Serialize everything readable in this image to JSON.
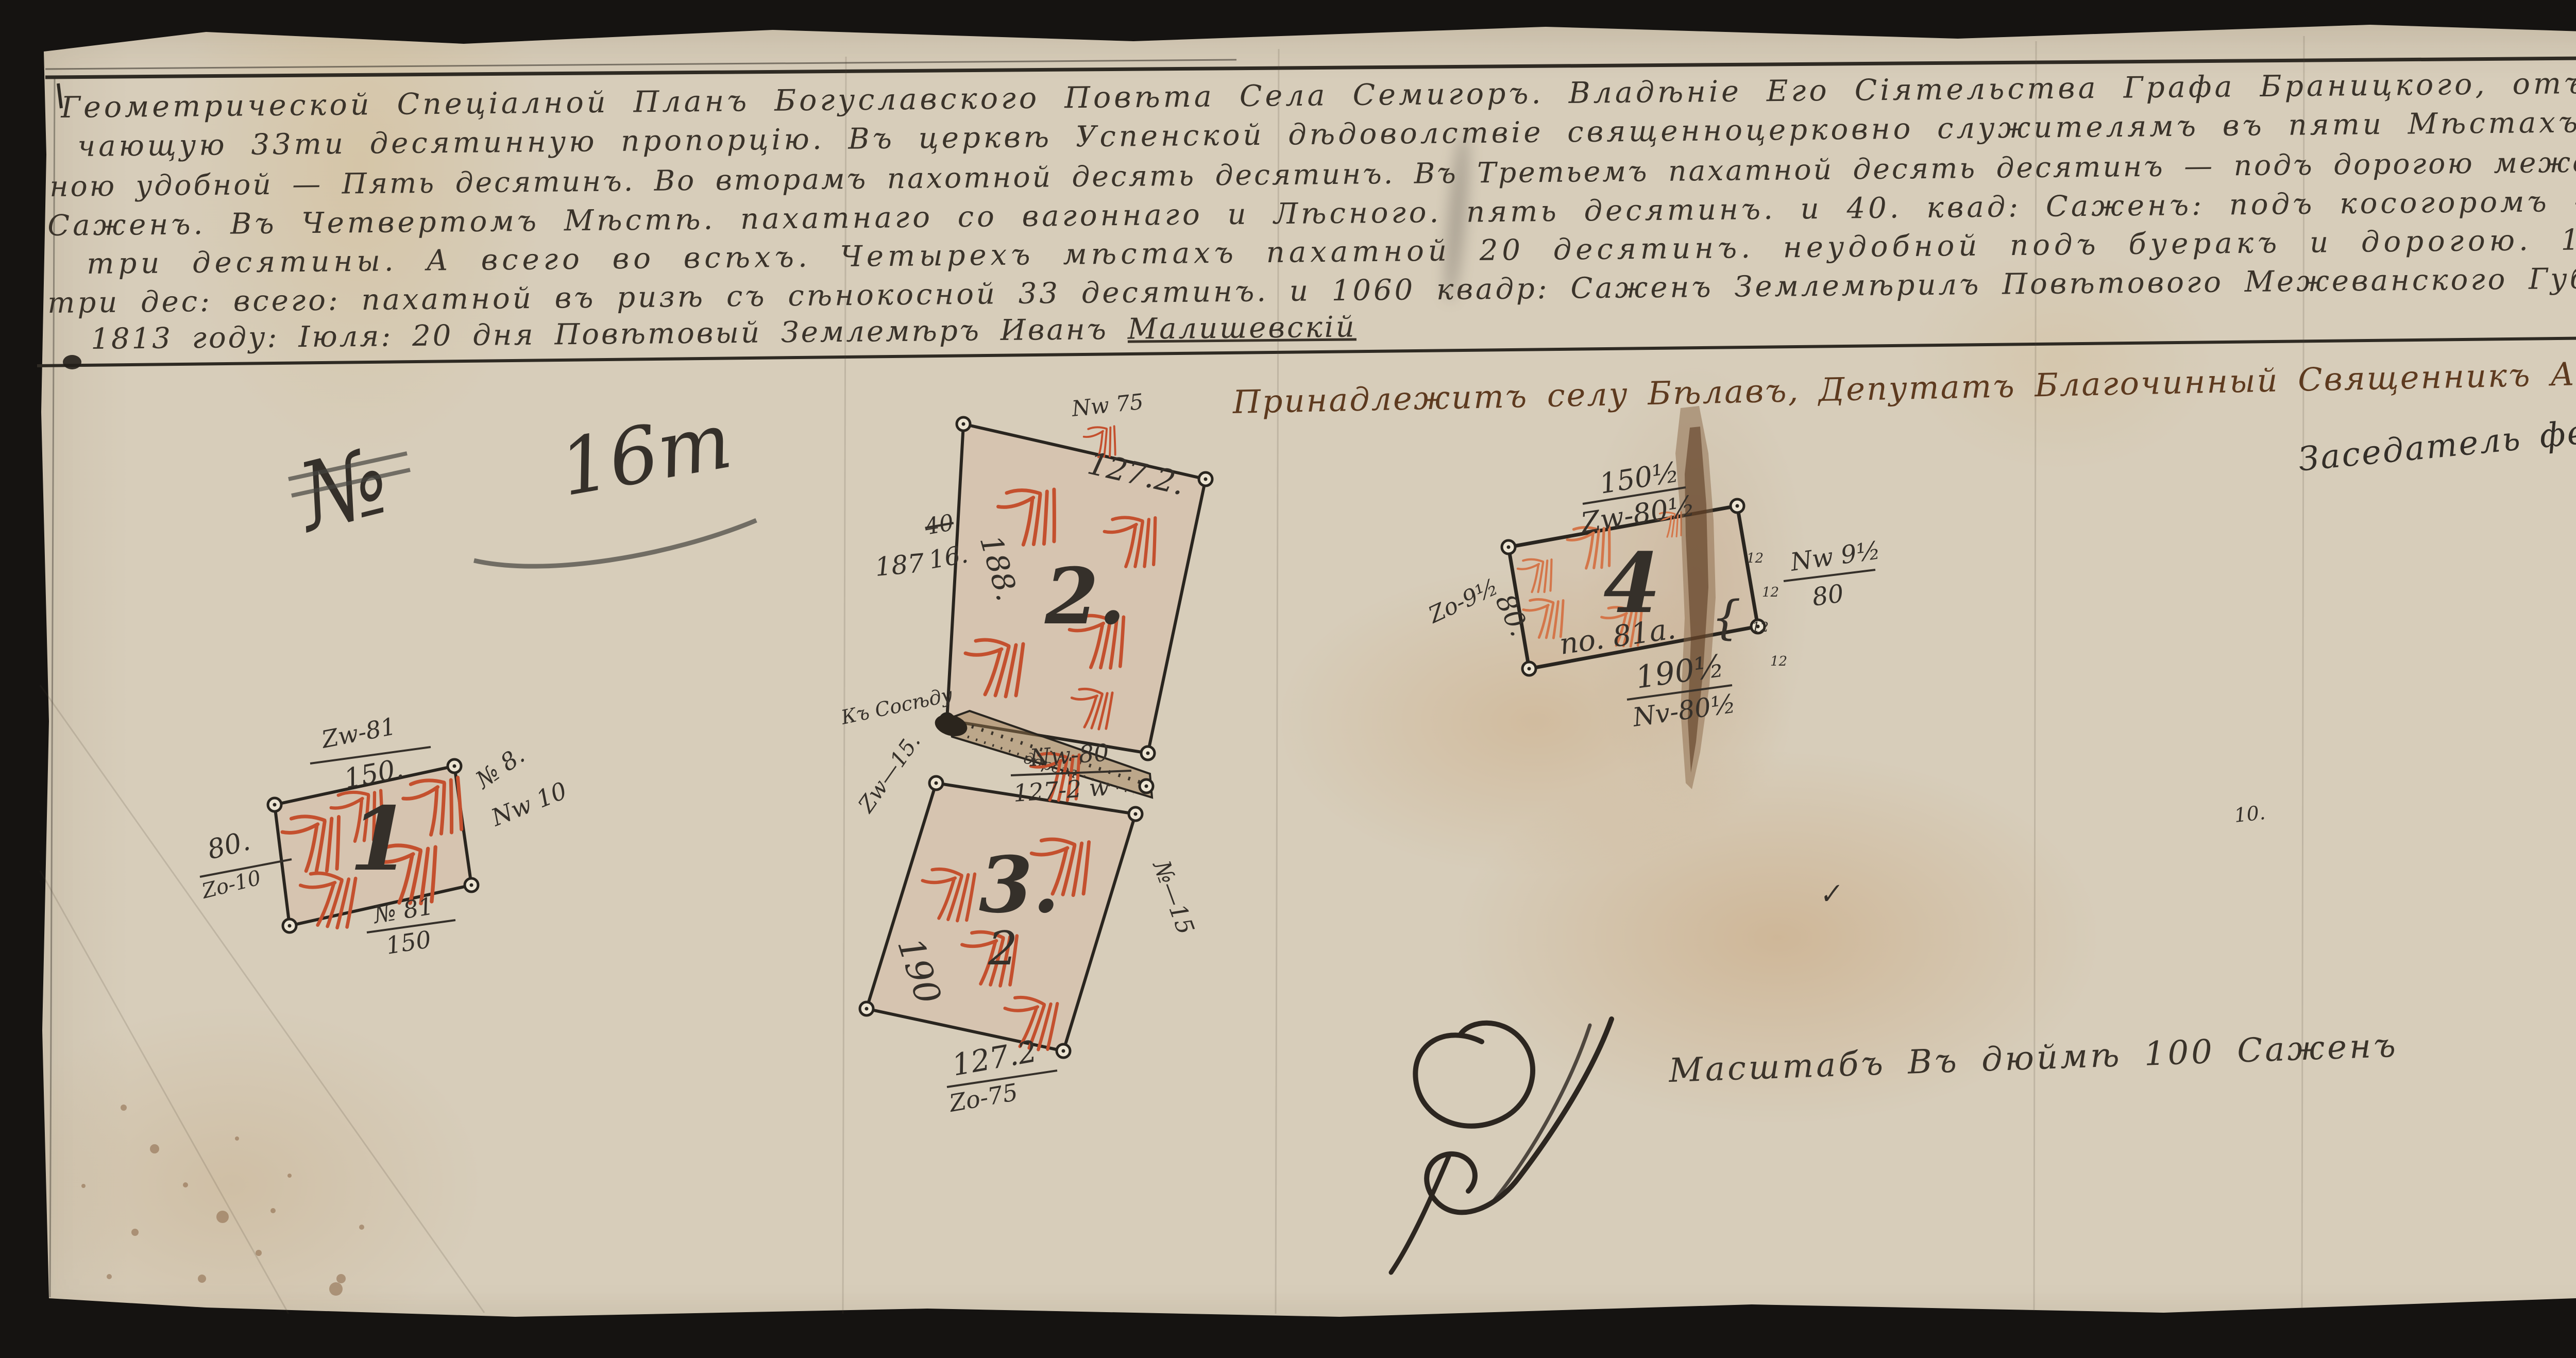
{
  "document": {
    "page_number": "1",
    "header_lines": [
      "Геометрической Спеціалной Планъ Богуславского Повѣта Села Семигоръ. Владѣніе Его Сіятельства Графа Браницкого, отъ межеванной Земли заклю-",
      "чающую 33ти десятинную пропорцію. Въ церквѣ Успенской дѣдоволствіе священноцерковно служителямъ въ пяти Мѣстахъ, имянно Въ первомъ пахот-",
      "ною удобной — Пять десятинъ. Во вторамъ пахотной десять десятинъ. Въ Третьемъ пахатной десять десятинъ — подъ дорогою между тѣми Мѣстами. 1020 квад:",
      "Саженъ. Въ Четвертомъ Мѣстѣ. пахатнаго со вагоннаго и Лѣсного. пять десятинъ. и 40. квад: Саженъ: подъ косогоромъ — Въ пятомъ мѣстѣ Сѣнокосу",
      "три десятины. А всего во всѣхъ. Четырехъ мѣстахъ пахатной 20 десятинъ. неудобной подъ буеракъ и дорогою. 1060. квадр: Саженъ. сѣнокосу",
      "три дес: всего: пахатной въ ризѣ съ сѣнокосной 33 десятинъ. и 1060 квадр: Саженъ Землемѣрилъ Повѣтового Межеванского Губернскаго Правленія"
    ],
    "footer_line": {
      "text": "1813 году: Іюля: 20 дня Повѣтовый Землемѣръ Иванъ",
      "signature": "Малишевскій"
    },
    "attestation": {
      "line1": "Принадлежитъ селу Бѣлавъ, Депутатъ Благочинный Священникъ Александръ Горовенковъ",
      "line2": "Заседатель федоръ Мишуковъ"
    },
    "scale_note": "Масштабъ Въ дюймѣ 100 Саженъ"
  },
  "plots": [
    {
      "number": "1",
      "top_length": "Zw-81",
      "top_length_den": "150.",
      "right_num": "№ 8.",
      "right_den": "Nw 10",
      "left_num": "80.",
      "left_den": "Zo-10",
      "bottom_num": "№ 81",
      "bottom_den": "150"
    },
    {
      "number": "2.",
      "corner_label": "Nw 75",
      "top_edge_length": "127.2.",
      "outside_left": "187",
      "struck_number": "40",
      "revised_number": "16.",
      "left_edge_length": "188."
    },
    {
      "number": "3.",
      "top_num": "Nw-80",
      "top_den": "127-2 w",
      "left_diag": "Zw—15.",
      "left_edge_length": "190",
      "right_diag": "№—15",
      "bottom_num": "127.2",
      "bottom_den": "Zo-75"
    },
    {
      "number": "4",
      "top_num": "150½",
      "top_den": "Zw-80½",
      "right_num": "Nw 9½",
      "right_den": "80",
      "left_edge": "80.",
      "far_left": "Zo-9½",
      "inside_note": "no. 81a.",
      "bottom_num": "190½",
      "bottom_den": "Nv-80½"
    },
    {
      "number": "",
      "top_label": "Zw 62",
      "top_edge_length": "51.2",
      "side_cursive": "Урочище",
      "side_length": "140.",
      "right_label": "Nw-29",
      "left_num": "Zo-29",
      "left_den": "140",
      "bottom_num": "№-62",
      "bottom_den": "1-2 w",
      "diag_word1": "Церковный",
      "diag_word2": "Грунтовъ"
    }
  ],
  "roads": {
    "road_between_2_3_label": "Къ Сосѣду",
    "road_between_2_3_note": "дорога"
  },
  "misc": {
    "pencil_paraph": "№",
    "pencil_note": "16т",
    "faint_number": "10.",
    "check_mark": "✓",
    "faint_two": "2",
    "depth_mark": "12",
    "curly_brace": "{"
  },
  "colors": {
    "paper": "#d7cdba",
    "ink": "#35302a",
    "brown_ink": "#5d3a1f",
    "hachure_red": "#c4502e",
    "hachure_orange": "#d4764a",
    "pencil": "#6b6560"
  }
}
